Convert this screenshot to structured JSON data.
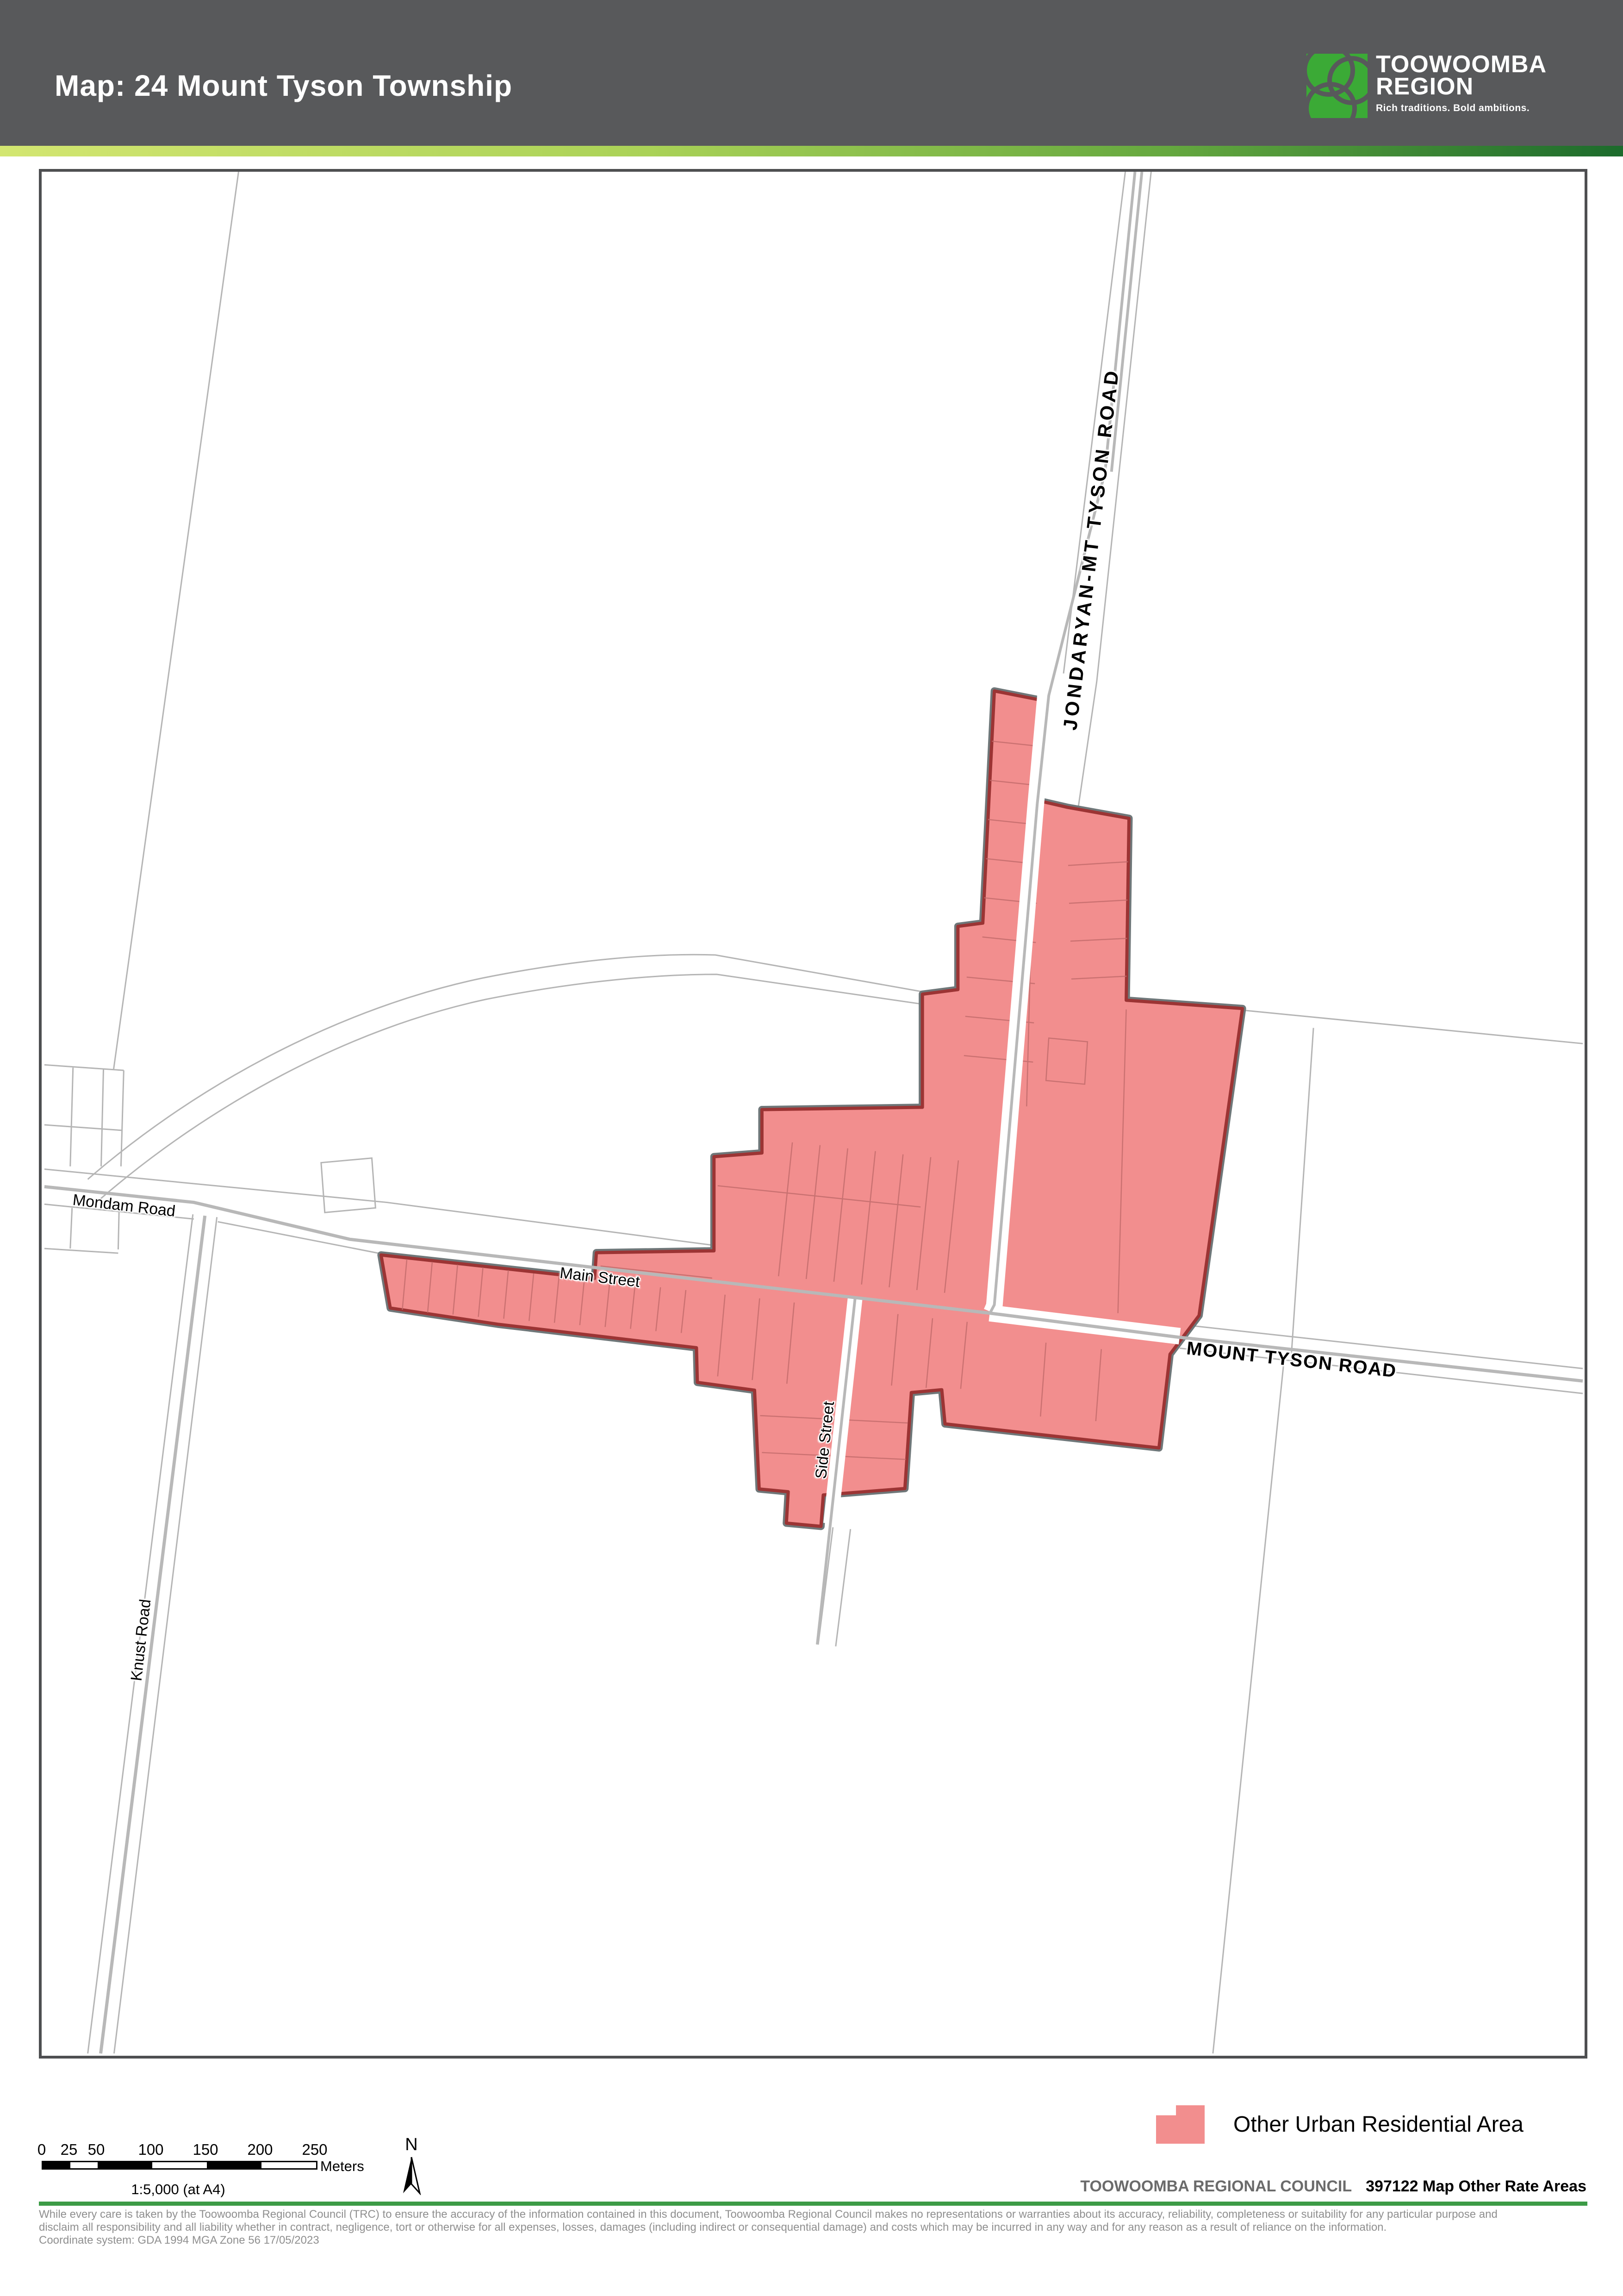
{
  "header": {
    "title": "Map: 24 Mount Tyson Township",
    "logo": {
      "line1": "TOOWOOMBA",
      "line2": "REGION",
      "tagline": "Rich traditions. Bold ambitions."
    }
  },
  "map": {
    "labels": {
      "jondaryan": "JONDARYAN-MT TYSON ROAD",
      "mount_tyson": "MOUNT TYSON ROAD",
      "main_street": "Main Street",
      "side_street": "Side Street",
      "mondam_road": "Mondam Road",
      "knust_road": "Knust Road"
    }
  },
  "legend": {
    "items": [
      {
        "label": "Other Urban Residential Area",
        "color": "#F28E8E"
      }
    ]
  },
  "scalebar": {
    "ticks": [
      "0",
      "25",
      "50",
      "100",
      "150",
      "200",
      "250"
    ],
    "unit": "Meters",
    "ratio": "1:5,000 (at A4)",
    "north": "N"
  },
  "footer": {
    "council": "TOOWOOMBA REGIONAL COUNCIL",
    "map_ref": "397122 Map Other Rate Areas",
    "disclaimer_line1": "While every care is taken by the Toowoomba Regional Council (TRC) to ensure the accuracy of the information contained in this document, Toowoomba Regional Council makes no representations or warranties about its accuracy, reliability, completeness or suitability for any particular purpose and",
    "disclaimer_line2": "disclaim all responsibility and all liability whether in contract, negligence, tort or otherwise for all expenses, losses, damages (including indirect or consequential damage) and costs which may be incurred in any way and for any reason as a result of reliance on the information.",
    "coordinate_line": "Coordinate system: GDA 1994 MGA Zone 56 17/05/2023"
  },
  "colors": {
    "header_bg": "#58595B",
    "accent_green": "#3C9B46",
    "logo_green": "#3BAA36",
    "area_fill": "#F28E8E",
    "area_border": "#9C3434",
    "road_centerline": "#B8B8B8"
  }
}
